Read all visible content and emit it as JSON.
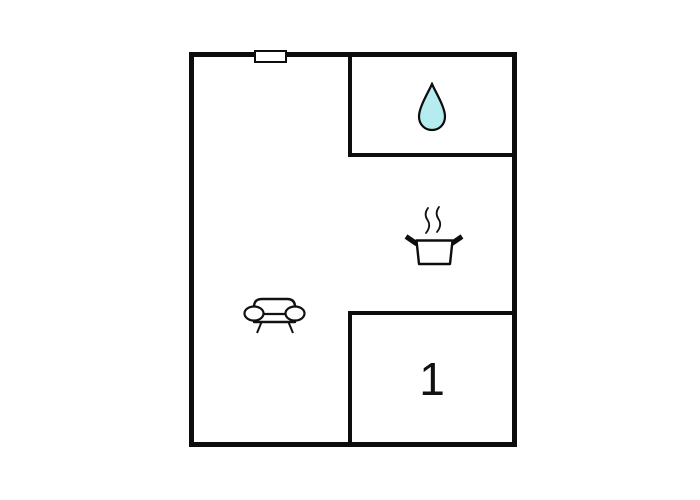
{
  "plan": {
    "type": "floor-plan",
    "rooms": {
      "bathroom": {
        "icon": "water-drop-icon"
      },
      "kitchen": {
        "icon": "cooking-pot-icon"
      },
      "living_area": {
        "icon": "sofa-icon"
      },
      "bedroom": {
        "label": "1"
      }
    },
    "features": {
      "window": "window-marker"
    },
    "colors": {
      "wall": "#0d0d0d",
      "background": "#ffffff",
      "water_drop_fill": "#b5ecf0"
    }
  }
}
